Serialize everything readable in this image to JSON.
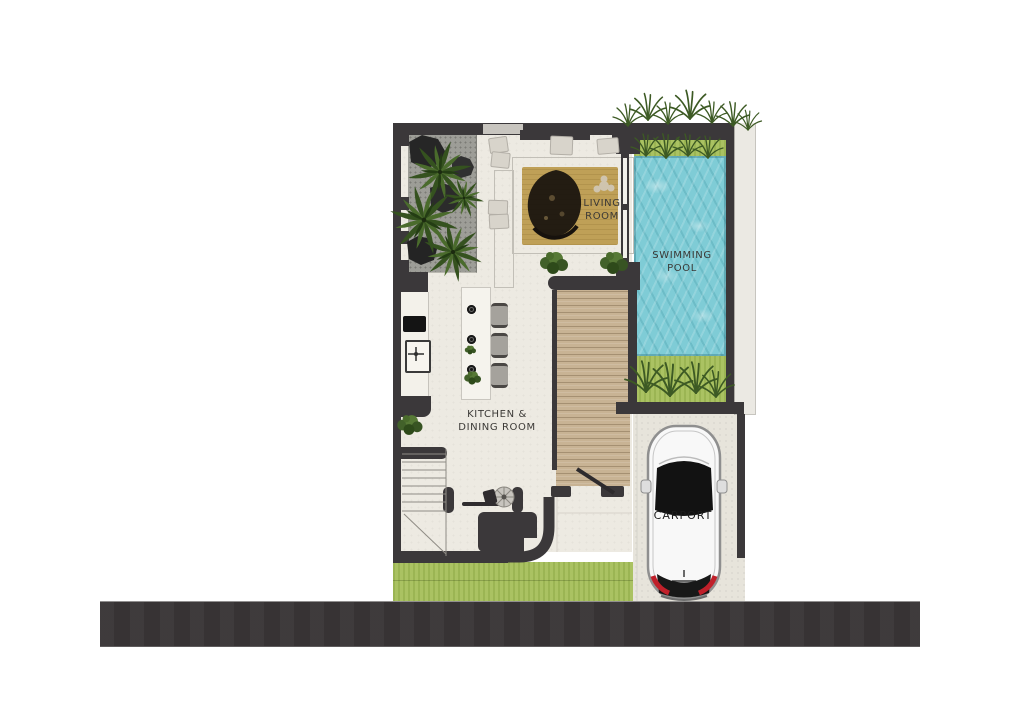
{
  "page": {
    "description": "Top-view architectural ground floor plan of a villa with courtyard garden, living room, kitchen and dining room, wooden deck, swimming pool and carport beside a road"
  },
  "rooms": {
    "living_room": {
      "label_line1": "LIVING",
      "label_line2": "ROOM"
    },
    "swimming_pool": {
      "label_line1": "SWIMMING",
      "label_line2": "POOL"
    },
    "kitchen_dining": {
      "label_line1": "KITCHEN &",
      "label_line2": "DINING ROOM"
    },
    "carport": {
      "label": "CARPORT"
    }
  },
  "colors": {
    "wall": "#3b383a",
    "floor": "#edeae2",
    "gravel_bed": "#9d9d97",
    "rug": "#bfa057",
    "deck_wood": "#c8b394",
    "pool_water": "#7fccd6",
    "grass": "#a6bf5a",
    "road": "#3a3637",
    "walkway": "#ebe9e3",
    "car_body": "#f8f8f8",
    "tail_light_red": "#c0202a"
  },
  "objects": [
    "palm-plant",
    "rock",
    "grass-tuft",
    "floor-cushion",
    "area-rug",
    "kitchen-island",
    "bar-stool",
    "sink",
    "cooktop",
    "stairs",
    "bench-sofa",
    "round-table",
    "wood-deck",
    "swimming-pool",
    "hatchback-car",
    "road",
    "side-walkway"
  ]
}
